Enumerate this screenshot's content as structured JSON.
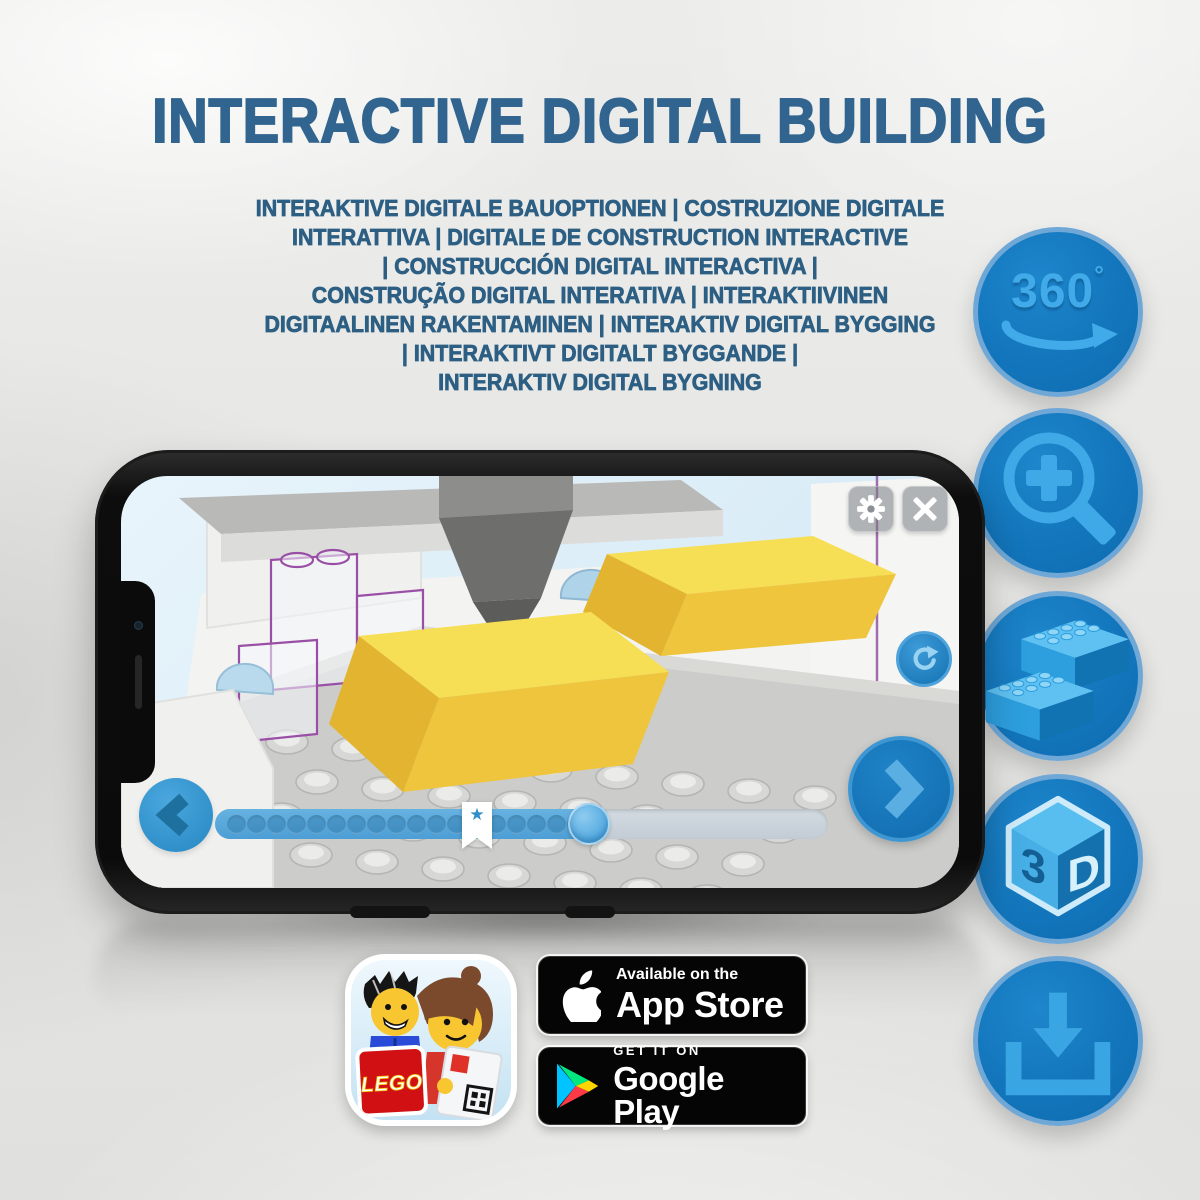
{
  "header": {
    "title": "INTERACTIVE DIGITAL BUILDING",
    "subtitle_lines": [
      "INTERAKTIVE DIGITALE BAUOPTIONEN | COSTRUZIONE DIGITALE",
      "INTERATTIVA | DIGITALE DE CONSTRUCTION INTERACTIVE",
      "| CONSTRUCCIÓN DIGITAL INTERACTIVA |",
      "CONSTRUÇÃO DIGITAL INTERATIVA | INTERAKTIIVINEN",
      "DIGITAALINEN RAKENTAMINEN | INTERAKTIV DIGITAL BYGGING",
      "| INTERAKTIVT DIGITALT BYGGANDE |",
      "INTERAKTIV DIGITAL BYGNING"
    ]
  },
  "feature_icons": {
    "rotate_360": {
      "icon": "rotate-360-icon",
      "label": "360",
      "degree": "°"
    },
    "zoom_in": {
      "icon": "zoom-in-magnifier-icon"
    },
    "bricks": {
      "icon": "lego-bricks-icon"
    },
    "cube_3d": {
      "icon": "cube-3d-icon",
      "left_face": "3",
      "right_face": "D"
    },
    "download": {
      "icon": "download-icon"
    }
  },
  "app_screen": {
    "buttons": [
      "settings-gear",
      "close",
      "rotate-model",
      "previous-step",
      "next-step"
    ],
    "progress": {
      "percent_complete": 61,
      "dot_count": 18,
      "star_glyph": "★"
    }
  },
  "badges": {
    "lego_app": {
      "logo_text": "LEGO"
    },
    "app_store": {
      "line1": "Available on the",
      "line2": "App Store"
    },
    "google_play": {
      "line1": "GET IT ON",
      "line2": "Google Play"
    }
  },
  "colors": {
    "title_blue": "#31648F",
    "subtitle_blue": "#2C5F83",
    "icon_circle_blue": "#1376BC",
    "icon_glyph_blue": "#41AAE9",
    "screen_bg_blue": "#DDEEF8",
    "brick_yellow": "#F2CE3D",
    "progress_blue": "#57A8DC",
    "badge_black": "#050505"
  }
}
